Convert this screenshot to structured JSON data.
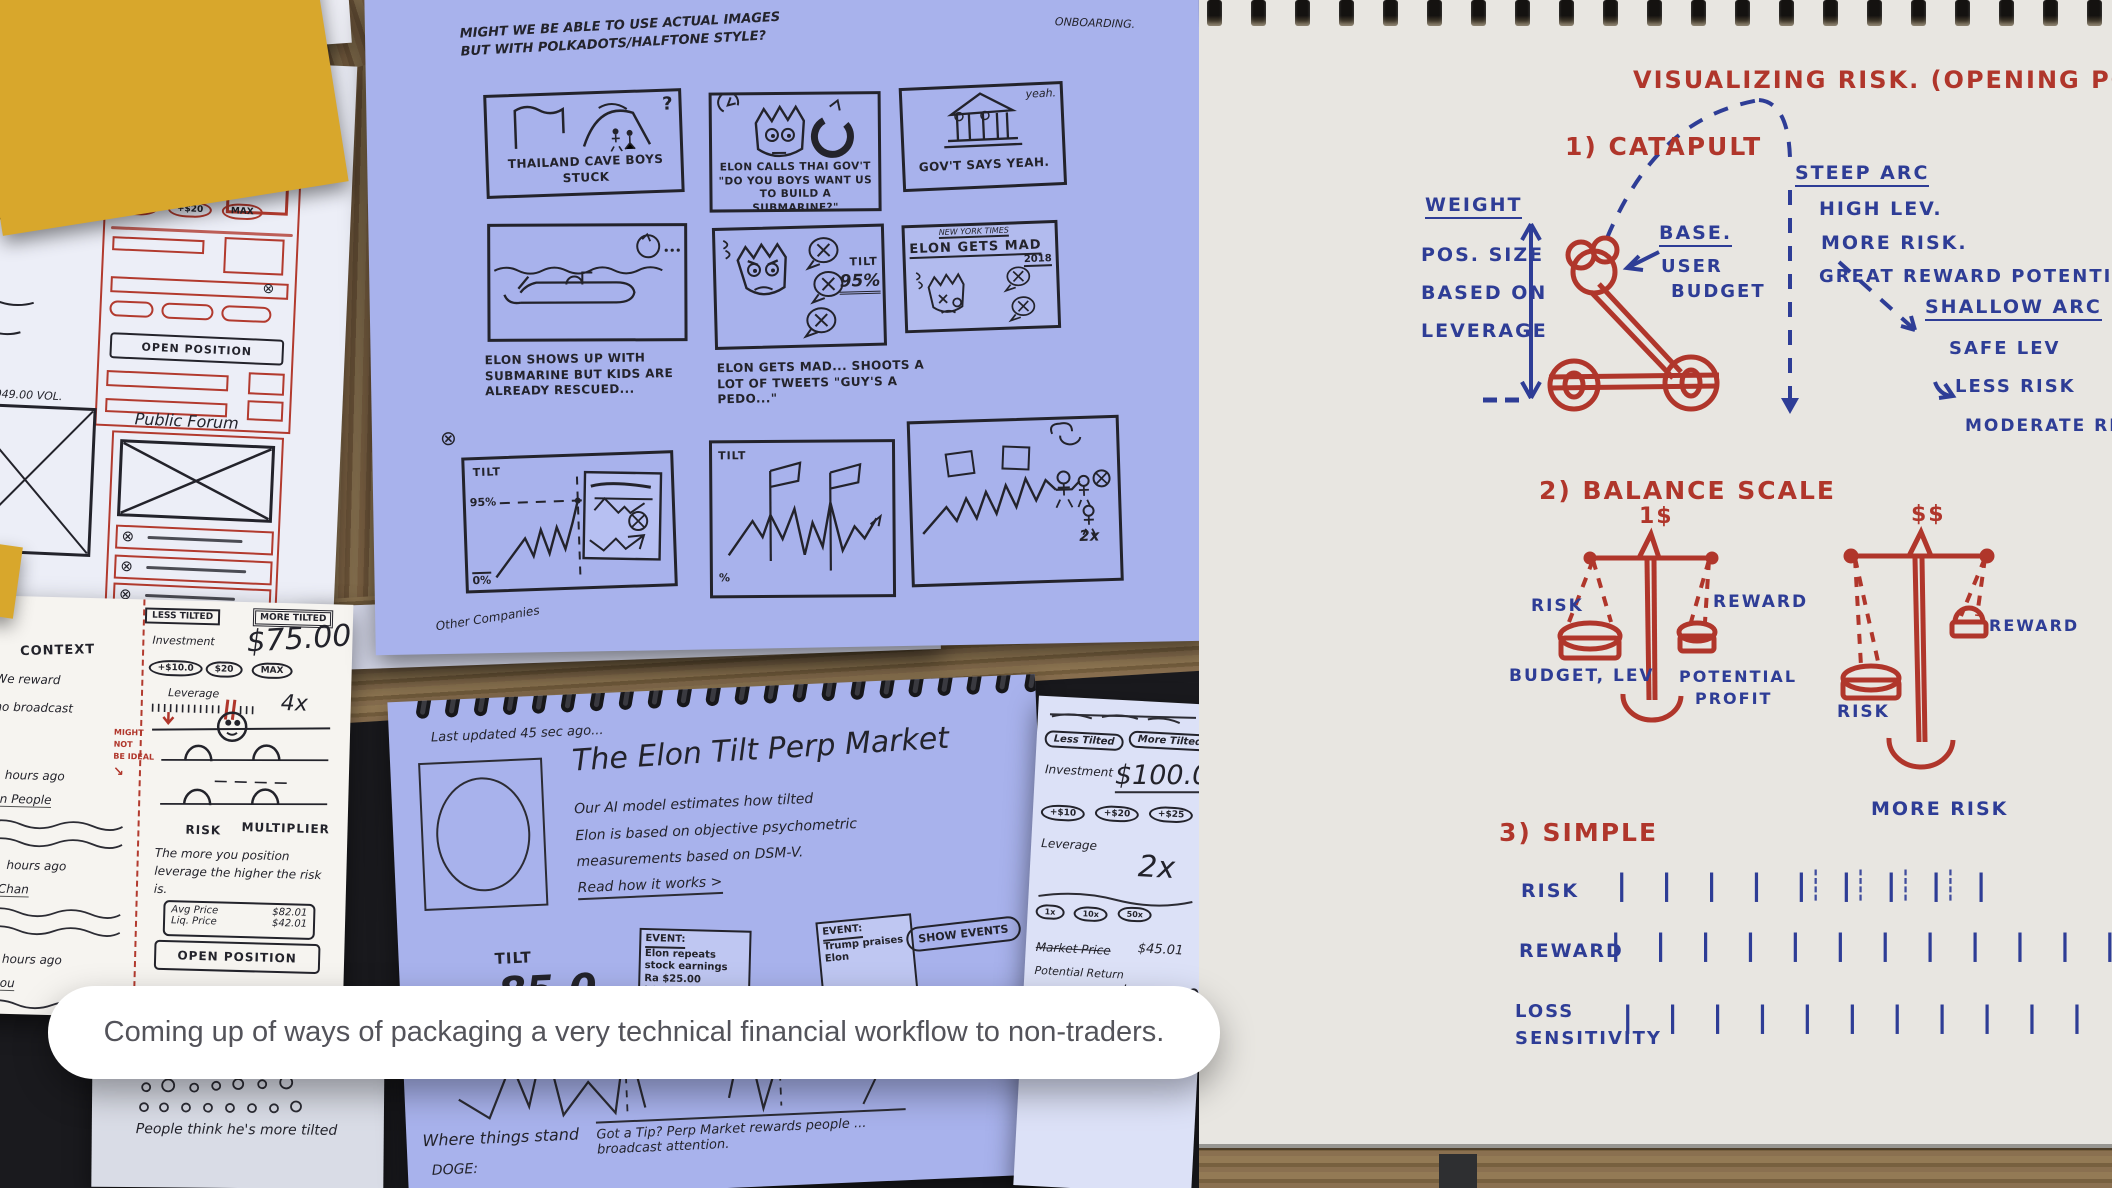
{
  "caption": {
    "text": "Coming up of ways of packaging a very technical financial workflow to non-traders."
  },
  "icons": {
    "crossed_circle": "⊗",
    "down_arrow": "↓",
    "curve_arrow": "↘"
  },
  "page1": {
    "top_note": "How it works",
    "give_perp": "GIVE THE PERP",
    "sign_in": "Sign In",
    "pills": [
      "+$10",
      "+$20",
      "MAX"
    ],
    "open_position": "OPEN POSITION",
    "vol": "2,008,049.00 VOL.",
    "forum_title": "Public Forum"
  },
  "page2": {
    "less_tilted": "LESS TILTED",
    "more_tilted": "MORE TILTED",
    "investment": "Investment",
    "amount": "$75.00",
    "pills": [
      "+$10.0",
      "$20",
      "MAX"
    ],
    "leverage": "Leverage",
    "multiplier": "4x",
    "risk": "RISK",
    "multiplier_label": "MULTIPLIER",
    "note": "The more you position leverage the higher the risk is.",
    "avg_price": "Avg Price",
    "avg_price_value": "$82.01",
    "liq_price": "Liq. Price",
    "liq_price_value": "$42.01",
    "open_position": "OPEN POSITION",
    "margin_note": [
      "MIGHT",
      "NOT",
      "BE IDEAL"
    ],
    "context": "CONTEXT",
    "context_lines": [
      "We reward",
      "who broadcast",
      "hours ago",
      "In People",
      "hours ago",
      "Chan",
      "hours ago",
      "Mou"
    ]
  },
  "storyboard": {
    "top_note": "MIGHT WE BE ABLE TO USE ACTUAL IMAGES BUT WITH POLKADOTS/HALFTONE STYLE?",
    "corner_note": "ONBOARDING.",
    "footer": "Other Companies",
    "panels": {
      "p1": {
        "caption": "THAILAND CAVE BOYS STUCK",
        "mark": "?"
      },
      "p2": {
        "caption": "ELON CALLS THAI GOV'T \"DO YOU BOYS WANT US TO BUILD A SUBMARINE?\""
      },
      "p3": {
        "caption": "GOV'T SAYS YEAH.",
        "bubble": "yeah."
      },
      "p4": {
        "caption": "ELON SHOWS UP WITH SUBMARINE BUT KIDS ARE ALREADY RESCUED..."
      },
      "p5": {
        "caption": "ELON GETS MAD... SHOOTS A LOT OF TWEETS \"GUY'S A PEDO...\"",
        "tilt": "TILT",
        "pct": "95%"
      },
      "p6": {
        "masthead": "NEW YORK TIMES",
        "headline": "ELON GETS MAD",
        "year": "2018"
      },
      "p7": {
        "tilt": "TILT",
        "top_pct": "95%",
        "bottom_pct": "0%"
      },
      "p8": {
        "tilt": "TILT",
        "pct": "%"
      },
      "p9": {
        "note": "2x"
      }
    }
  },
  "market": {
    "updated": "Last updated   45 sec ago...",
    "title": "The Elon Tilt Perp Market",
    "body_lines": [
      "Our AI model estimates how tilted",
      "Elon is based on objective psychometric",
      "measurements based on DSM-V."
    ],
    "read_more": "Read how it works >",
    "tilt": "TILT",
    "value": "85.0",
    "pct": "95%",
    "event1_lines": [
      "EVENT:",
      "Elon repeats",
      "stock earnings",
      "Ra $25.00",
      "LOW"
    ],
    "event2_lines": [
      "EVENT:",
      "Trump praises",
      "Elon"
    ],
    "show_events": "SHOW EVENTS",
    "things_stand": "Where things stand",
    "bullets": [
      "DOGE:",
      "Tesla:"
    ],
    "got_tip": "Got a Tip? Perp Market rewards people ... broadcast attention.",
    "people_think": "People think he's more tilted"
  },
  "controls": {
    "less": "Less Tilted",
    "more": "More Tilted",
    "investment": "Investment",
    "amount": "$100.0",
    "pills": [
      "+$10",
      "+$20",
      "+$25"
    ],
    "leverage": "Leverage",
    "lev_value": "2x",
    "lev_pills": [
      "1x",
      "10x",
      "50x"
    ],
    "market_price": "Market Price",
    "market_price_value": "$45.01",
    "potential_return": "Potential Return",
    "potential_return_value": "+$459.00",
    "market_price2": "Market Price",
    "market_price2_value": "$45.01",
    "liq_price": "Liquidation Price",
    "liq_price_value": "$46.01"
  },
  "risknote": {
    "title": "VISUALIZING   RISK. (OPENING POS)",
    "catapult": {
      "heading": "1) CATAPULT",
      "weight": "WEIGHT",
      "pos_lines": [
        "POS. SIZE",
        "BASED ON",
        "LEVERAGE"
      ],
      "base": "BASE.",
      "user_budget_lines": [
        "USER",
        "BUDGET"
      ],
      "steep_arc": "STEEP ARC",
      "steep_notes": [
        "HIGH LEV.",
        "MORE RISK.",
        "GREAT REWARD POTENTIAL."
      ],
      "shallow_arc": "SHALLOW ARC",
      "shallow_notes": [
        "SAFE LEV",
        "LESS RISK",
        "MODERATE REWARD"
      ]
    },
    "balance": {
      "heading": "2) BALANCE SCALE",
      "left_top": "1$",
      "left_risk": "RISK",
      "left_reward": "REWARD",
      "left_budget": "BUDGET, LEV",
      "left_profit_lines": [
        "POTENTIAL",
        "PROFIT"
      ],
      "right_top": "$$",
      "right_reward": "REWARD",
      "right_risk": "RISK",
      "right_more": "MORE RISK"
    },
    "simple": {
      "heading": "3) SIMPLE",
      "risk_label": "RISK",
      "risk_marks": "| | | | | | | | |",
      "risk_dotted": "┊ ┊ ┊ ┊",
      "reward_label": "REWARD",
      "reward_marks": "| | | | | | | | | | | | |",
      "loss_lines": [
        "LOSS",
        "SENSITIVITY"
      ],
      "loss_marks": "| | | | | | | | | | | |"
    }
  },
  "colors": {
    "red_ink": "#b0362b",
    "blue_ink": "#2e3d96",
    "black_ink": "#23232b",
    "paper_blue": "#a8b2ec",
    "paper_cream": "#e8e6e1"
  }
}
